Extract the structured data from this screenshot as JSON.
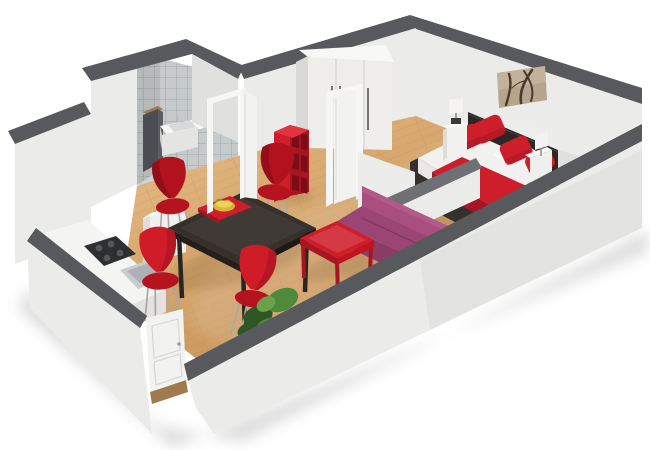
{
  "meta": {
    "type": "3d-floorplan-render",
    "description": "Perspective 3D floor plan of a studio apartment, white background",
    "background": "#ffffff"
  },
  "palette": {
    "wall": "#ebebe9",
    "wallSide": "#e0e0de",
    "wallShade": "#d9d9d7",
    "cap": "#58595c",
    "capSoft": "#6e7073",
    "tile": "#c6cacb",
    "tileLine": "#969da1",
    "tileFloor": "#ced2d3",
    "floorHi": "#e6bd85",
    "floorLo": "#c08a52",
    "plank": "#a87c46",
    "red": "#cf1e2b",
    "redDark": "#a51622",
    "redBright": "#e03440",
    "redDeep": "#7c0d16",
    "purple": "#a84f80",
    "purpleMid": "#9a4573",
    "purpleDark": "#8a3c67",
    "tableDark": "#35302c",
    "tableEdge": "#241f1c",
    "headboard": "#2c2624",
    "mattress": "#f2f1ef",
    "white": "#f6f6f4",
    "doorWhite": "#f2f2f0",
    "steel": "#c9ccce",
    "steelDark": "#aeb2b5",
    "appliance": "#2e2f31",
    "cabinetDark": "#4a4e52",
    "wood": "#a07a4e",
    "artBg": "#b5a58c",
    "artBranch": "#4a3a2c",
    "green": "#4e8a3c",
    "greenDark": "#2f5726",
    "greenLight": "#6aa24b",
    "tv": "#606366",
    "lampBase": "#3a3a3a",
    "chrome": "#a8a8a6",
    "bowl": "#d8b832",
    "floorShadow": "#7a5a33",
    "groundShadow": "#d2d2d2"
  },
  "scene": {
    "rooms": [
      "bathroom",
      "kitchen",
      "dining-area",
      "living-area",
      "bedroom"
    ],
    "objects": [
      "bathroom-tiled-walls",
      "bathroom-sink",
      "bathroom-cabinet",
      "bathroom-door",
      "kitchen-counter",
      "cooktop",
      "kitchen-sink",
      "kitchen-cabinet",
      "entry-door",
      "dining-table",
      "red-chairs",
      "fruit-bowl",
      "red-bookcase",
      "wardrobe",
      "bedroom-door",
      "wall-art",
      "double-bed",
      "red-pillows",
      "nightstands",
      "table-lamps",
      "purple-sofa",
      "red-coffee-table",
      "tv-panel",
      "houseplant",
      "low-partition-wall"
    ]
  }
}
